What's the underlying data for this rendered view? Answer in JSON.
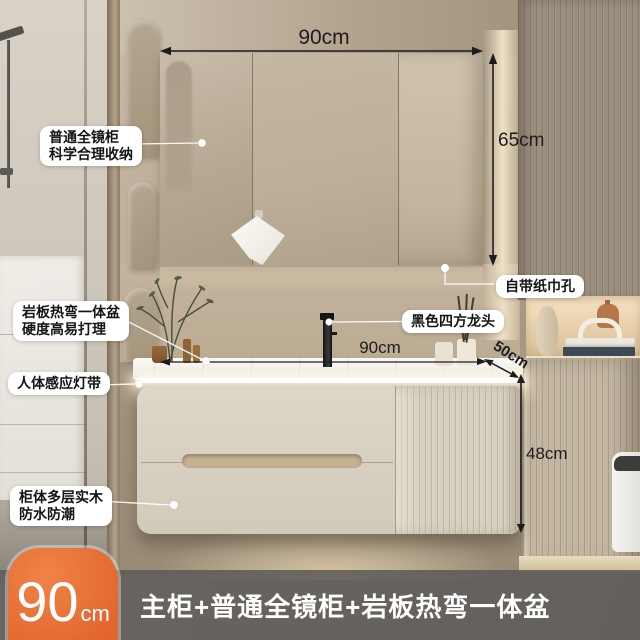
{
  "dims": {
    "top_width": "90cm",
    "mirror_height": "65cm",
    "counter_width": "90cm",
    "counter_depth": "50cm",
    "cabinet_height": "48cm"
  },
  "callouts": {
    "mirror_cabinet": {
      "line1": "普通全镜柜",
      "line2": "科学合理收纳"
    },
    "stone_basin": {
      "line1": "岩板热弯一体盆",
      "line2": "硬度高易打理"
    },
    "sensor_light": {
      "line1": "人体感应灯带"
    },
    "cabinet_material": {
      "line1": "柜体多层实木",
      "line2": "防水防潮"
    },
    "tissue_hole": {
      "line1": "自带纸巾孔"
    },
    "faucet": {
      "line1": "黑色四方龙头"
    }
  },
  "banner": {
    "badge_number": "90",
    "badge_unit": "cm",
    "title": "主柜+普通全镜柜+岩板热弯一体盆"
  },
  "colors": {
    "badge_orange": "#e86f38",
    "banner_gray": "#5c5a58",
    "dimension_ink": "#1c1c1c",
    "callout_bg": "#ffffff",
    "led_white": "#ffffff",
    "wall_beige": "#b7a791",
    "cabinet_cream": "#d8d1c2"
  }
}
